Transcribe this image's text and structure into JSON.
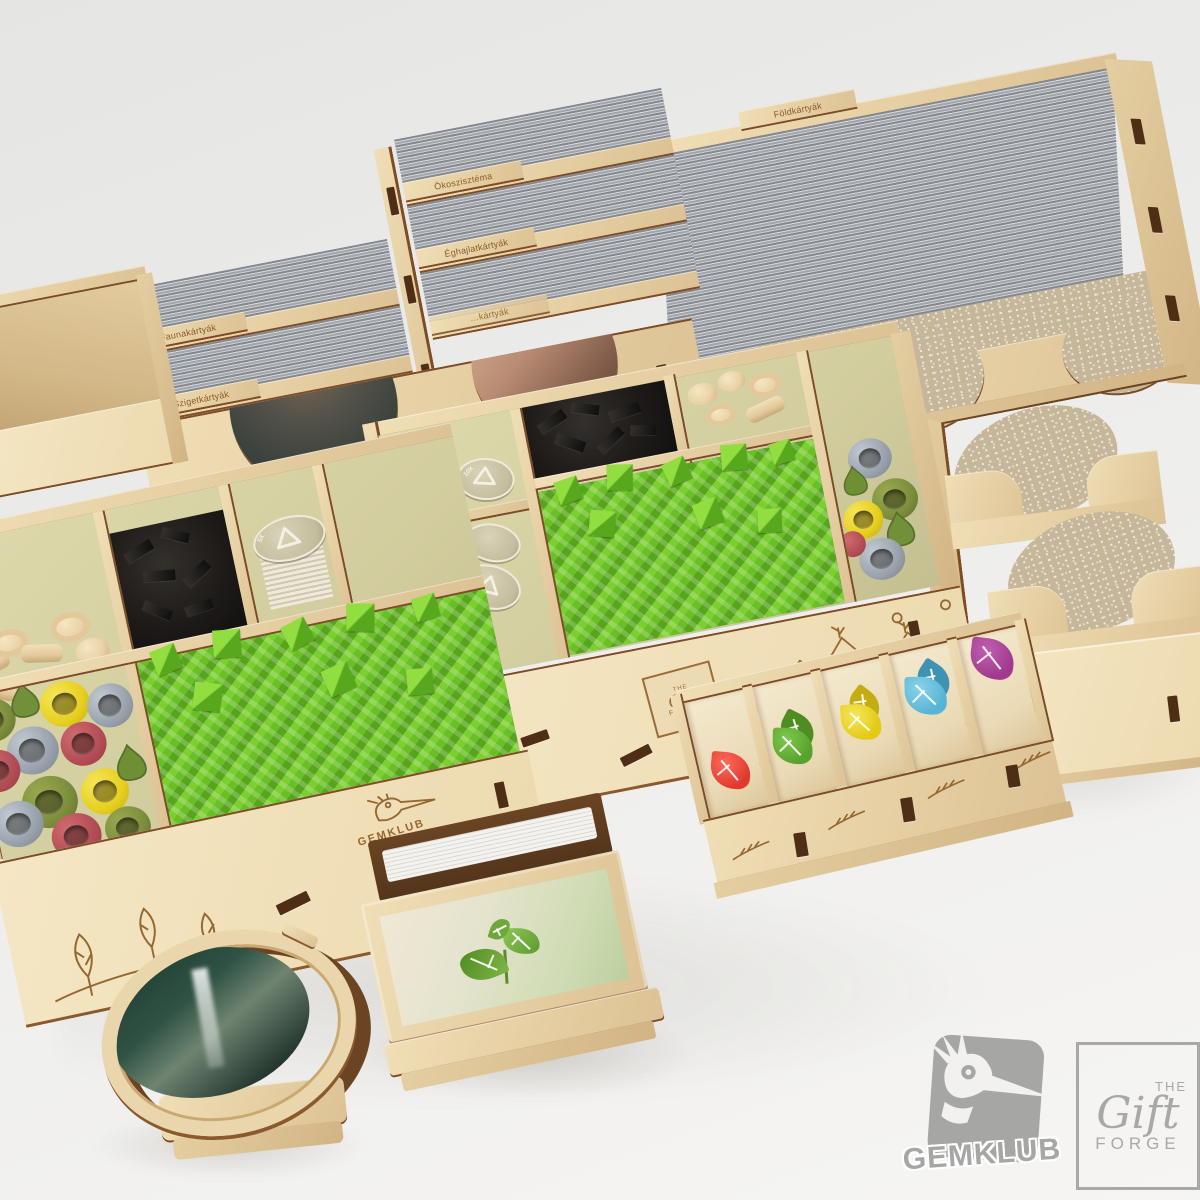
{
  "scene": {
    "background_top": "#e5e5e3",
    "background_bottom": "#f6f5f3"
  },
  "left_card_holder": {
    "tabs": {
      "fauna": "Faunakártyák",
      "sziget": "Szigetkártyák",
      "evszak": "Évszakkártyák",
      "okoszisztema": "Ökoszisztéma",
      "eghajlat": "Éghajlatkártyák",
      "hidden": "…kártyák"
    }
  },
  "right_card_holder": {
    "tab": "Földkártyák"
  },
  "tokens": {
    "multiplier_10x": "10X",
    "multiplier_5x": "5X"
  },
  "branding": {
    "gemklub": "GEMKLUB",
    "gift_forge": {
      "the": "THE",
      "gift": "Gift",
      "forge": "FORGE"
    }
  },
  "colors": {
    "plywood_light": "#ecd9ae",
    "plywood_mid": "#e0c899",
    "plywood_edge_brown": "#7d4b26",
    "engraving_brown": "#96672f",
    "interior_green_tan": "#d6d2a6",
    "card_edge_gray": "#a7abb0",
    "card_back_beige": "#c6b69a",
    "cube_green": "#6fbe2a",
    "token_cream": "#d9d4bd",
    "piece_black": "#1e1c1a",
    "piece_natural": "#ecd7ad",
    "pile_olive": "#7c8e3b",
    "pile_yellow": "#e8d41e",
    "pile_gray": "#9aa3ad",
    "pile_red": "#b34d55",
    "leaf_red": "#e03a2e",
    "leaf_green": "#58a32c",
    "leaf_yellow": "#e6cf1e",
    "leaf_blue": "#58b6d6",
    "leaf_purple": "#a43a90",
    "watermark_gray": "#a6a6a4"
  }
}
